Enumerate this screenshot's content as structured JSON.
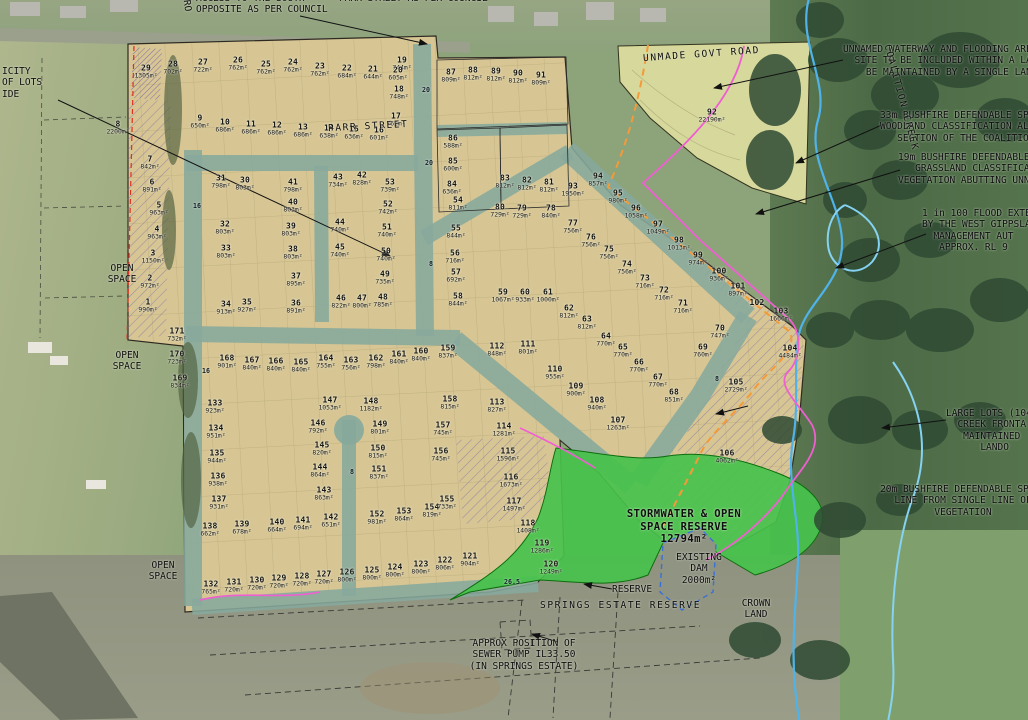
{
  "title": "Subdivision estate plan over aerial photo",
  "colors": {
    "estate_tan": "#d7c694",
    "road_teal": "#86a89c",
    "reserve_green": "#46c24c",
    "lot92_area": "#d6d89c",
    "creek_blue": "#4fb3ea",
    "flood_blue": "#85d2f2",
    "hatch_violet": "#7b68a6",
    "defendable_orange": "#f59a38",
    "overlay_magenta": "#ef5fd2",
    "boundary_red": "#e03020"
  },
  "annotations": [
    {
      "id": "council-note",
      "x": 196,
      "y": -7,
      "lines": [
        "ACCESS TO THE SOUTH      PARR STREET AS PER COUNCIL",
        "OPPOSITE AS PER COUNCIL"
      ]
    },
    {
      "id": "road-fragment",
      "x": 181,
      "y": 0,
      "rot": 83,
      "lines": [
        "RO"
      ]
    },
    {
      "id": "parr-street",
      "x": 328,
      "y": 121,
      "rot": -3,
      "cls": "sp",
      "lines": [
        "PARR STREET"
      ]
    },
    {
      "id": "unmade-govt-road",
      "x": 643,
      "y": 49,
      "rot": -4,
      "cls": "sp",
      "lines": [
        "UNMADE GOVT ROAD"
      ]
    },
    {
      "id": "waterway-note",
      "x": 843,
      "y": 44,
      "lines": [
        "UNNAMED WATERWAY AND FLOODING AREA",
        "  SITE TO BE INCLUDED WITHIN A LARGE",
        "    BE MAINTAINED BY A SINGLE LANDOW"
      ]
    },
    {
      "id": "bushfire-33m-note",
      "x": 880,
      "y": 110,
      "lines": [
        "33m BUSHFIRE DEFENDABLE SPAC",
        "WOODLAND CLASSIFICATION ALO",
        "   SECTION OF THE COALITION"
      ]
    },
    {
      "id": "bushfire-19m-note",
      "x": 898,
      "y": 152,
      "lines": [
        "19m BUSHFIRE DEFENDABLE S",
        "   GRASSLAND CLASSIFICA",
        "VEGETATION ABUTTING UNNA"
      ]
    },
    {
      "id": "flood-extent-note",
      "x": 922,
      "y": 208,
      "lines": [
        "1 in 100 FLOOD EXTEN",
        "BY THE WEST GIPPSLAN",
        "  MANAGEMENT AUT",
        "   APPROX. RL 9"
      ]
    },
    {
      "id": "coalition-creek",
      "x": 846,
      "y": 92,
      "rot": 75,
      "cls": "sp",
      "lines": [
        "COALITION CREEK"
      ]
    },
    {
      "id": "large-lots-note",
      "x": 946,
      "y": 408,
      "lines": [
        "LARGE LOTS (104,",
        "  CREEK FRONTA",
        "   MAINTAINED",
        "      LANDO"
      ]
    },
    {
      "id": "bushfire-20m-note",
      "x": 963,
      "y": 484,
      "cls": "ctr",
      "lines": [
        "20m BUSHFIRE DEFENDABLE SPACE",
        "LINE FROM SINGLE LINE OF",
        "VEGETATION"
      ]
    },
    {
      "id": "stormwater-reserve-label",
      "x": 684,
      "y": 508,
      "cls": "ctr big",
      "lines": [
        "STORMWATER & OPEN",
        "SPACE RESERVE",
        "12794m²"
      ]
    },
    {
      "id": "existing-dam-label",
      "x": 699,
      "y": 552,
      "cls": "ctr",
      "lines": [
        "EXISTING",
        "DAM",
        "2000m²"
      ]
    },
    {
      "id": "crown-land-label",
      "x": 756,
      "y": 598,
      "cls": "ctr",
      "lines": [
        "CROWN",
        "LAND"
      ]
    },
    {
      "id": "reserve-label",
      "x": 612,
      "y": 584,
      "lines": [
        "RESERVE"
      ]
    },
    {
      "id": "springs-estate-reserve-label",
      "x": 540,
      "y": 600,
      "cls": "sp",
      "lines": [
        "SPRINGS ESTATE RESERVE"
      ]
    },
    {
      "id": "sewer-pump-note",
      "x": 524,
      "y": 638,
      "cls": "ctr",
      "lines": [
        "APPROX POSITION OF",
        "SEWER PUMP IL33.50",
        "(IN SPRINGS ESTATE)"
      ]
    },
    {
      "id": "lots-note-left",
      "x": 2,
      "y": 66,
      "lines": [
        "ICITY",
        "OF LOTS",
        "IDE"
      ]
    },
    {
      "id": "open-space-1",
      "x": 122,
      "y": 263,
      "cls": "ctr",
      "lines": [
        "OPEN",
        "SPACE"
      ]
    },
    {
      "id": "open-space-2",
      "x": 127,
      "y": 350,
      "cls": "ctr",
      "lines": [
        "OPEN",
        "SPACE"
      ]
    },
    {
      "id": "open-space-3",
      "x": 163,
      "y": 560,
      "cls": "ctr",
      "lines": [
        "OPEN",
        "SPACE"
      ]
    }
  ],
  "road_markers": [
    {
      "t": "20",
      "x": 426,
      "y": 90
    },
    {
      "t": "20",
      "x": 429,
      "y": 163
    },
    {
      "t": "16",
      "x": 197,
      "y": 206
    },
    {
      "t": "16",
      "x": 206,
      "y": 371
    },
    {
      "t": "8",
      "x": 431,
      "y": 264
    },
    {
      "t": "8",
      "x": 352,
      "y": 472
    },
    {
      "t": "8",
      "x": 717,
      "y": 379
    },
    {
      "t": "26.5",
      "x": 512,
      "y": 582
    }
  ],
  "lots": [
    {
      "n": "1",
      "a": "990m²",
      "x": 148,
      "y": 306
    },
    {
      "n": "2",
      "a": "972m²",
      "x": 150,
      "y": 282
    },
    {
      "n": "3",
      "a": "1150m²",
      "x": 153,
      "y": 257
    },
    {
      "n": "4",
      "a": "963m²",
      "x": 157,
      "y": 233
    },
    {
      "n": "5",
      "a": "963m²",
      "x": 159,
      "y": 209
    },
    {
      "n": "6",
      "a": "891m²",
      "x": 152,
      "y": 186
    },
    {
      "n": "7",
      "a": "842m²",
      "x": 150,
      "y": 163
    },
    {
      "n": "8",
      "a": "2200m²",
      "x": 118,
      "y": 128
    },
    {
      "n": "9",
      "a": "650m²",
      "x": 200,
      "y": 122
    },
    {
      "n": "10",
      "a": "686m²",
      "x": 225,
      "y": 126
    },
    {
      "n": "11",
      "a": "686m²",
      "x": 251,
      "y": 128
    },
    {
      "n": "12",
      "a": "686m²",
      "x": 277,
      "y": 129
    },
    {
      "n": "13",
      "a": "686m²",
      "x": 303,
      "y": 131
    },
    {
      "n": "14",
      "a": "638m²",
      "x": 329,
      "y": 132
    },
    {
      "n": "15",
      "a": "636m²",
      "x": 354,
      "y": 133
    },
    {
      "n": "16",
      "a": "601m²",
      "x": 379,
      "y": 134
    },
    {
      "n": "17",
      "a": "762m²",
      "x": 396,
      "y": 120
    },
    {
      "n": "18",
      "a": "748m²",
      "x": 399,
      "y": 93
    },
    {
      "n": "19",
      "a": "744m²",
      "x": 402,
      "y": 64
    },
    {
      "n": "20",
      "a": "605m²",
      "x": 398,
      "y": 74
    },
    {
      "n": "21",
      "a": "644m²",
      "x": 373,
      "y": 73
    },
    {
      "n": "22",
      "a": "684m²",
      "x": 347,
      "y": 72
    },
    {
      "n": "23",
      "a": "762m²",
      "x": 320,
      "y": 70
    },
    {
      "n": "24",
      "a": "762m²",
      "x": 293,
      "y": 66
    },
    {
      "n": "25",
      "a": "762m²",
      "x": 266,
      "y": 68
    },
    {
      "n": "26",
      "a": "762m²",
      "x": 238,
      "y": 64
    },
    {
      "n": "27",
      "a": "722m²",
      "x": 203,
      "y": 66
    },
    {
      "n": "28",
      "a": "702m²",
      "x": 173,
      "y": 68
    },
    {
      "n": "29",
      "a": "1305m²",
      "x": 146,
      "y": 72
    },
    {
      "n": "30",
      "a": "803m²",
      "x": 245,
      "y": 184
    },
    {
      "n": "31",
      "a": "798m²",
      "x": 221,
      "y": 182
    },
    {
      "n": "32",
      "a": "803m²",
      "x": 225,
      "y": 228
    },
    {
      "n": "33",
      "a": "803m²",
      "x": 226,
      "y": 252
    },
    {
      "n": "34",
      "a": "913m²",
      "x": 226,
      "y": 308
    },
    {
      "n": "35",
      "a": "927m²",
      "x": 247,
      "y": 306
    },
    {
      "n": "36",
      "a": "891m²",
      "x": 296,
      "y": 307
    },
    {
      "n": "37",
      "a": "895m²",
      "x": 296,
      "y": 280
    },
    {
      "n": "38",
      "a": "803m²",
      "x": 293,
      "y": 253
    },
    {
      "n": "39",
      "a": "803m²",
      "x": 291,
      "y": 230
    },
    {
      "n": "40",
      "a": "803m²",
      "x": 293,
      "y": 206
    },
    {
      "n": "41",
      "a": "798m²",
      "x": 293,
      "y": 186
    },
    {
      "n": "42",
      "a": "828m²",
      "x": 362,
      "y": 179
    },
    {
      "n": "43",
      "a": "734m²",
      "x": 338,
      "y": 181
    },
    {
      "n": "44",
      "a": "740m²",
      "x": 340,
      "y": 226
    },
    {
      "n": "45",
      "a": "740m²",
      "x": 340,
      "y": 251
    },
    {
      "n": "46",
      "a": "822m²",
      "x": 341,
      "y": 302
    },
    {
      "n": "47",
      "a": "800m²",
      "x": 362,
      "y": 302
    },
    {
      "n": "48",
      "a": "785m²",
      "x": 383,
      "y": 301
    },
    {
      "n": "49",
      "a": "735m²",
      "x": 385,
      "y": 278
    },
    {
      "n": "50",
      "a": "740m²",
      "x": 386,
      "y": 255
    },
    {
      "n": "51",
      "a": "740m²",
      "x": 387,
      "y": 231
    },
    {
      "n": "52",
      "a": "742m²",
      "x": 388,
      "y": 208
    },
    {
      "n": "53",
      "a": "739m²",
      "x": 390,
      "y": 186
    },
    {
      "n": "54",
      "a": "811m²",
      "x": 458,
      "y": 204
    },
    {
      "n": "55",
      "a": "844m²",
      "x": 456,
      "y": 232
    },
    {
      "n": "56",
      "a": "716m²",
      "x": 455,
      "y": 257
    },
    {
      "n": "57",
      "a": "692m²",
      "x": 456,
      "y": 276
    },
    {
      "n": "58",
      "a": "844m²",
      "x": 458,
      "y": 300
    },
    {
      "n": "59",
      "a": "1067m²",
      "x": 503,
      "y": 296
    },
    {
      "n": "60",
      "a": "933m²",
      "x": 525,
      "y": 296
    },
    {
      "n": "61",
      "a": "1000m²",
      "x": 548,
      "y": 296
    },
    {
      "n": "62",
      "a": "812m²",
      "x": 569,
      "y": 312
    },
    {
      "n": "63",
      "a": "812m²",
      "x": 587,
      "y": 323
    },
    {
      "n": "64",
      "a": "770m²",
      "x": 606,
      "y": 340
    },
    {
      "n": "65",
      "a": "770m²",
      "x": 623,
      "y": 351
    },
    {
      "n": "66",
      "a": "770m²",
      "x": 639,
      "y": 366
    },
    {
      "n": "67",
      "a": "770m²",
      "x": 658,
      "y": 381
    },
    {
      "n": "68",
      "a": "851m²",
      "x": 674,
      "y": 396
    },
    {
      "n": "69",
      "a": "760m²",
      "x": 703,
      "y": 351
    },
    {
      "n": "70",
      "a": "747m²",
      "x": 720,
      "y": 332
    },
    {
      "n": "71",
      "a": "716m²",
      "x": 683,
      "y": 307
    },
    {
      "n": "72",
      "a": "716m²",
      "x": 664,
      "y": 294
    },
    {
      "n": "73",
      "a": "716m²",
      "x": 645,
      "y": 282
    },
    {
      "n": "74",
      "a": "756m²",
      "x": 627,
      "y": 268
    },
    {
      "n": "75",
      "a": "756m²",
      "x": 609,
      "y": 253
    },
    {
      "n": "76",
      "a": "756m²",
      "x": 591,
      "y": 241
    },
    {
      "n": "77",
      "a": "756m²",
      "x": 573,
      "y": 227
    },
    {
      "n": "78",
      "a": "840m²",
      "x": 551,
      "y": 212
    },
    {
      "n": "79",
      "a": "729m²",
      "x": 522,
      "y": 212
    },
    {
      "n": "80",
      "a": "729m²",
      "x": 500,
      "y": 211
    },
    {
      "n": "81",
      "a": "812m²",
      "x": 549,
      "y": 186
    },
    {
      "n": "82",
      "a": "812m²",
      "x": 527,
      "y": 184
    },
    {
      "n": "83",
      "a": "812m²",
      "x": 505,
      "y": 182
    },
    {
      "n": "84",
      "a": "636m²",
      "x": 452,
      "y": 188
    },
    {
      "n": "85",
      "a": "600m²",
      "x": 453,
      "y": 165
    },
    {
      "n": "86",
      "a": "588m²",
      "x": 453,
      "y": 142
    },
    {
      "n": "87",
      "a": "809m²",
      "x": 451,
      "y": 76
    },
    {
      "n": "88",
      "a": "812m²",
      "x": 473,
      "y": 74
    },
    {
      "n": "89",
      "a": "812m²",
      "x": 496,
      "y": 75
    },
    {
      "n": "90",
      "a": "812m²",
      "x": 518,
      "y": 77
    },
    {
      "n": "91",
      "a": "809m²",
      "x": 541,
      "y": 79
    },
    {
      "n": "92",
      "a": "22190m²",
      "x": 712,
      "y": 116
    },
    {
      "n": "93",
      "a": "1950m²",
      "x": 573,
      "y": 190
    },
    {
      "n": "94",
      "a": "857m²",
      "x": 598,
      "y": 180
    },
    {
      "n": "95",
      "a": "980m²",
      "x": 618,
      "y": 197
    },
    {
      "n": "96",
      "a": "1058m²",
      "x": 636,
      "y": 212
    },
    {
      "n": "97",
      "a": "1049m²",
      "x": 658,
      "y": 228
    },
    {
      "n": "98",
      "a": "1013m²",
      "x": 679,
      "y": 244
    },
    {
      "n": "99",
      "a": "974m²",
      "x": 698,
      "y": 259
    },
    {
      "n": "100",
      "a": "936m²",
      "x": 719,
      "y": 275
    },
    {
      "n": "101",
      "a": "897m²",
      "x": 738,
      "y": 290
    },
    {
      "n": "102",
      "x": 757,
      "y": 303
    },
    {
      "n": "103",
      "a": "1666m²",
      "x": 781,
      "y": 315
    },
    {
      "n": "104",
      "a": "4484m²",
      "x": 790,
      "y": 352
    },
    {
      "n": "105",
      "a": "2729m²",
      "x": 736,
      "y": 386
    },
    {
      "n": "106",
      "a": "4062m²",
      "x": 727,
      "y": 457
    },
    {
      "n": "107",
      "a": "1263m²",
      "x": 618,
      "y": 424
    },
    {
      "n": "108",
      "a": "940m²",
      "x": 597,
      "y": 404
    },
    {
      "n": "109",
      "a": "900m²",
      "x": 576,
      "y": 390
    },
    {
      "n": "110",
      "a": "955m²",
      "x": 555,
      "y": 373
    },
    {
      "n": "111",
      "a": "801m²",
      "x": 528,
      "y": 348
    },
    {
      "n": "112",
      "a": "848m²",
      "x": 497,
      "y": 350
    },
    {
      "n": "113",
      "a": "827m²",
      "x": 497,
      "y": 406
    },
    {
      "n": "114",
      "a": "1281m²",
      "x": 504,
      "y": 430
    },
    {
      "n": "115",
      "a": "1596m²",
      "x": 508,
      "y": 455
    },
    {
      "n": "116",
      "a": "1673m²",
      "x": 511,
      "y": 481
    },
    {
      "n": "117",
      "a": "1497m²",
      "x": 514,
      "y": 505
    },
    {
      "n": "118",
      "a": "1408m²",
      "x": 528,
      "y": 527
    },
    {
      "n": "119",
      "a": "1286m²",
      "x": 542,
      "y": 547
    },
    {
      "n": "120",
      "a": "1249m²",
      "x": 551,
      "y": 568
    },
    {
      "n": "121",
      "a": "904m²",
      "x": 470,
      "y": 560
    },
    {
      "n": "122",
      "a": "806m²",
      "x": 445,
      "y": 564
    },
    {
      "n": "123",
      "a": "800m²",
      "x": 421,
      "y": 568
    },
    {
      "n": "124",
      "a": "800m²",
      "x": 395,
      "y": 571
    },
    {
      "n": "125",
      "a": "800m²",
      "x": 372,
      "y": 574
    },
    {
      "n": "126",
      "a": "800m²",
      "x": 347,
      "y": 576
    },
    {
      "n": "127",
      "a": "720m²",
      "x": 324,
      "y": 578
    },
    {
      "n": "128",
      "a": "720m²",
      "x": 302,
      "y": 580
    },
    {
      "n": "129",
      "a": "720m²",
      "x": 279,
      "y": 582
    },
    {
      "n": "130",
      "a": "720m²",
      "x": 257,
      "y": 584
    },
    {
      "n": "131",
      "a": "720m²",
      "x": 234,
      "y": 586
    },
    {
      "n": "132",
      "a": "765m²",
      "x": 211,
      "y": 588
    },
    {
      "n": "133",
      "a": "923m²",
      "x": 215,
      "y": 407
    },
    {
      "n": "134",
      "a": "951m²",
      "x": 216,
      "y": 432
    },
    {
      "n": "135",
      "a": "944m²",
      "x": 217,
      "y": 457
    },
    {
      "n": "136",
      "a": "938m²",
      "x": 218,
      "y": 480
    },
    {
      "n": "137",
      "a": "931m²",
      "x": 219,
      "y": 503
    },
    {
      "n": "138",
      "a": "662m²",
      "x": 210,
      "y": 530
    },
    {
      "n": "139",
      "a": "678m²",
      "x": 242,
      "y": 528
    },
    {
      "n": "140",
      "a": "664m²",
      "x": 277,
      "y": 526
    },
    {
      "n": "141",
      "a": "694m²",
      "x": 303,
      "y": 524
    },
    {
      "n": "142",
      "a": "651m²",
      "x": 331,
      "y": 521
    },
    {
      "n": "143",
      "a": "863m²",
      "x": 324,
      "y": 494
    },
    {
      "n": "144",
      "a": "864m²",
      "x": 320,
      "y": 471
    },
    {
      "n": "145",
      "a": "820m²",
      "x": 322,
      "y": 449
    },
    {
      "n": "146",
      "a": "792m²",
      "x": 318,
      "y": 427
    },
    {
      "n": "147",
      "a": "1053m²",
      "x": 330,
      "y": 404
    },
    {
      "n": "148",
      "a": "1182m²",
      "x": 371,
      "y": 405
    },
    {
      "n": "149",
      "a": "801m²",
      "x": 380,
      "y": 428
    },
    {
      "n": "150",
      "a": "815m²",
      "x": 378,
      "y": 452
    },
    {
      "n": "151",
      "a": "837m²",
      "x": 379,
      "y": 473
    },
    {
      "n": "152",
      "a": "981m²",
      "x": 377,
      "y": 518
    },
    {
      "n": "153",
      "a": "864m²",
      "x": 404,
      "y": 515
    },
    {
      "n": "154",
      "a": "819m²",
      "x": 432,
      "y": 511
    },
    {
      "n": "155",
      "a": "733m²",
      "x": 447,
      "y": 503
    },
    {
      "n": "156",
      "a": "745m²",
      "x": 441,
      "y": 455
    },
    {
      "n": "157",
      "a": "745m²",
      "x": 443,
      "y": 429
    },
    {
      "n": "158",
      "a": "815m²",
      "x": 450,
      "y": 403
    },
    {
      "n": "159",
      "a": "837m²",
      "x": 448,
      "y": 352
    },
    {
      "n": "160",
      "a": "840m²",
      "x": 421,
      "y": 355
    },
    {
      "n": "161",
      "a": "840m²",
      "x": 399,
      "y": 358
    },
    {
      "n": "162",
      "a": "798m²",
      "x": 376,
      "y": 362
    },
    {
      "n": "163",
      "a": "756m²",
      "x": 351,
      "y": 364
    },
    {
      "n": "164",
      "a": "755m²",
      "x": 326,
      "y": 362
    },
    {
      "n": "165",
      "a": "840m²",
      "x": 301,
      "y": 366
    },
    {
      "n": "166",
      "a": "840m²",
      "x": 276,
      "y": 365
    },
    {
      "n": "167",
      "a": "840m²",
      "x": 252,
      "y": 364
    },
    {
      "n": "168",
      "a": "901m²",
      "x": 227,
      "y": 362
    },
    {
      "n": "169",
      "a": "834m²",
      "x": 180,
      "y": 382
    },
    {
      "n": "170",
      "a": "723m²",
      "x": 177,
      "y": 358
    },
    {
      "n": "171",
      "a": "732m²",
      "x": 177,
      "y": 335
    }
  ]
}
